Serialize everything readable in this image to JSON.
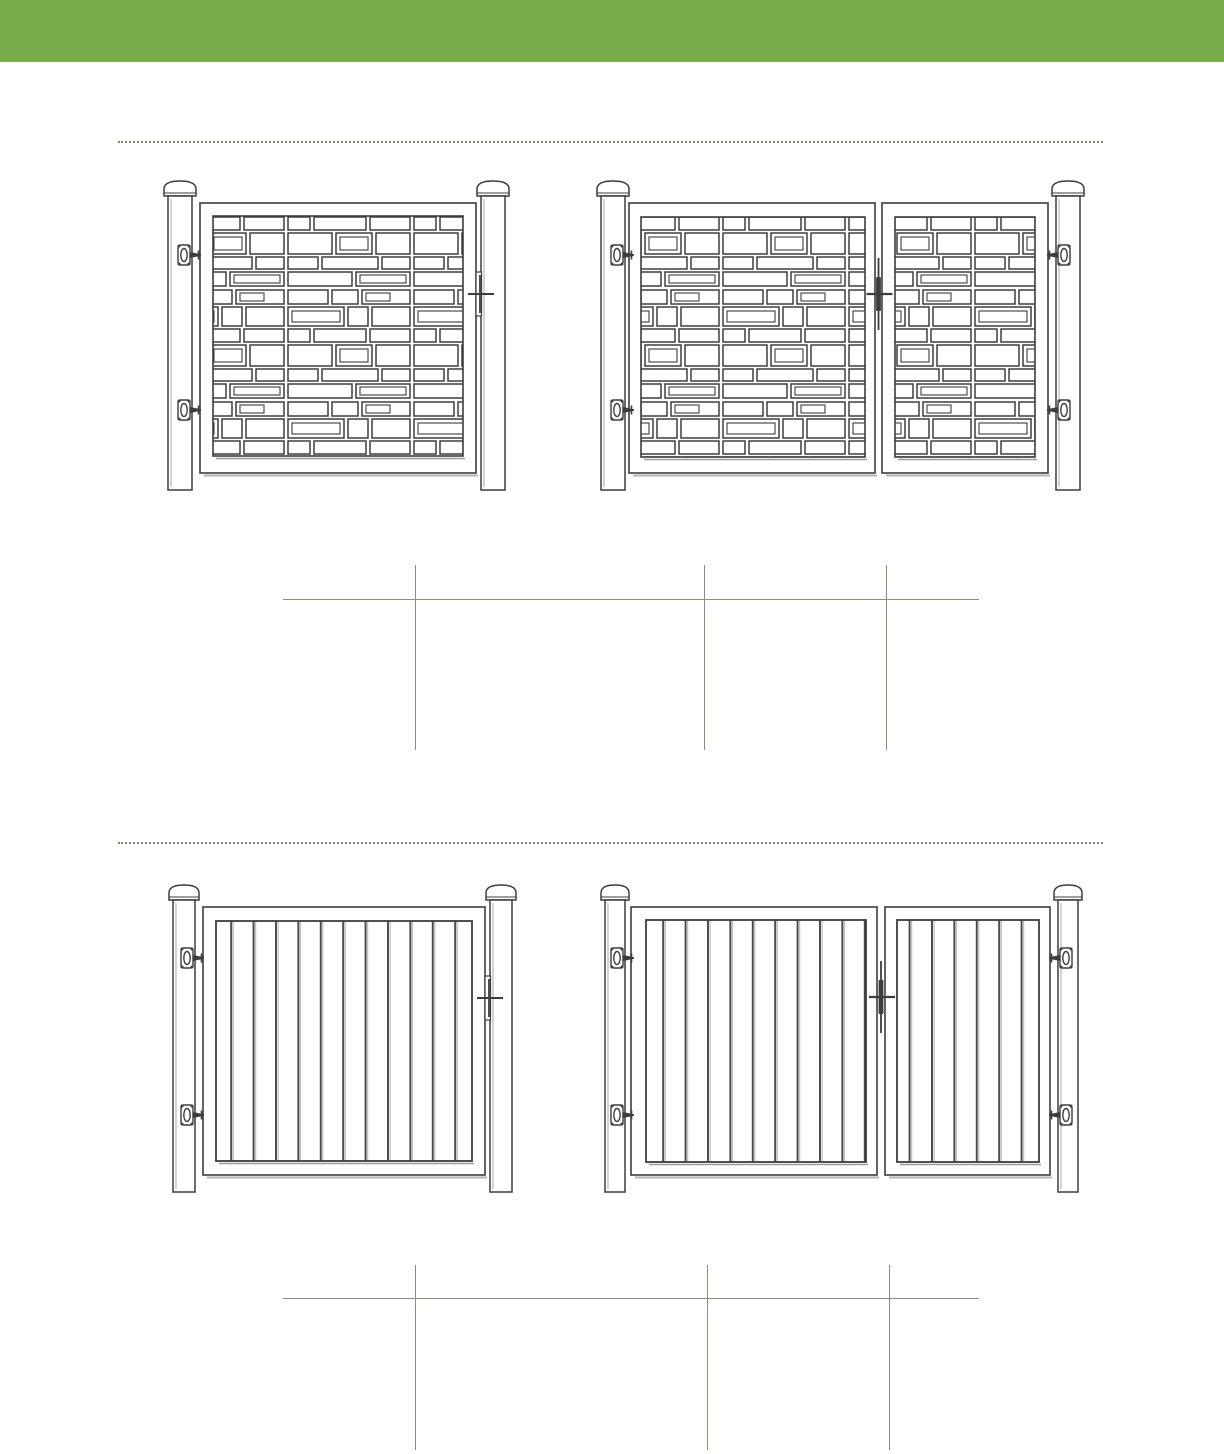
{
  "page": {
    "kind": "fence-gate-catalog-page",
    "visible_text": "",
    "colors": {
      "header_green": "#78ab4a",
      "rule_olive": "#8e8e78",
      "drawing_stroke": "#3d3d3d",
      "background": "#ffffff"
    }
  },
  "header": {
    "label": ""
  },
  "sections": [
    {
      "name": "mosaic-infill-gates",
      "drawings": [
        {
          "name": "single-gate-mosaic",
          "style": "random rectangle mosaic infill, post each side with dome cap, two hinges left, latch right"
        },
        {
          "name": "double-gate-mosaic",
          "style": "random rectangle mosaic infill, wide left leaf and narrow right leaf, hinges on both posts, center latch"
        }
      ],
      "spec_table": {
        "header_rule": true,
        "column_dividers": 3,
        "cells": [
          [
            "",
            "",
            "",
            ""
          ],
          [
            "",
            "",
            "",
            ""
          ]
        ]
      }
    },
    {
      "name": "vertical-board-infill-gates",
      "drawings": [
        {
          "name": "single-gate-boards",
          "style": "vertical board infill, post each side with dome cap, two hinges left, latch right"
        },
        {
          "name": "double-gate-boards",
          "style": "vertical board infill, wide left leaf and narrow right leaf, hinges on both posts, center latch"
        }
      ],
      "spec_table": {
        "header_rule": true,
        "column_dividers": 3,
        "cells": [
          [
            "",
            "",
            "",
            ""
          ],
          [
            "",
            "",
            "",
            ""
          ]
        ]
      }
    }
  ]
}
